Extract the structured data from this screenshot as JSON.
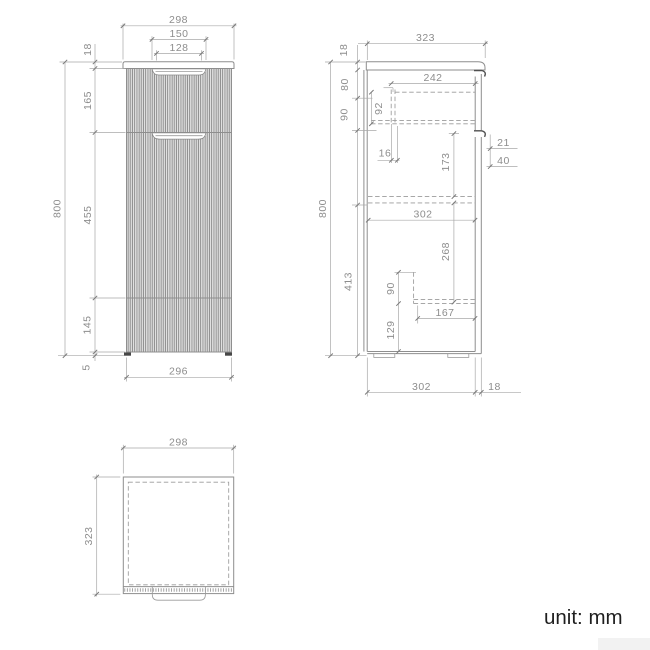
{
  "footer": {
    "unit_label": "unit: mm"
  },
  "front": {
    "w_top": "298",
    "handle_w": "150",
    "handle_inner": "128",
    "t_top": "18",
    "h_drawer": "165",
    "h_door": "455",
    "h_base": "145",
    "h_total": "800",
    "gap": "5",
    "w_bottom": "296"
  },
  "side": {
    "d_top": "323",
    "t_top": "18",
    "w_back": "242",
    "v80": "80",
    "v92": "92",
    "v90": "90",
    "w16": "16",
    "v173": "173",
    "d21": "21",
    "d40": "40",
    "h_total": "800",
    "iw": "302",
    "v268": "268",
    "v413": "413",
    "v90b": "90",
    "w167": "167",
    "v129": "129",
    "bw": "302",
    "bt": "18"
  },
  "top": {
    "w": "298",
    "d": "323"
  }
}
